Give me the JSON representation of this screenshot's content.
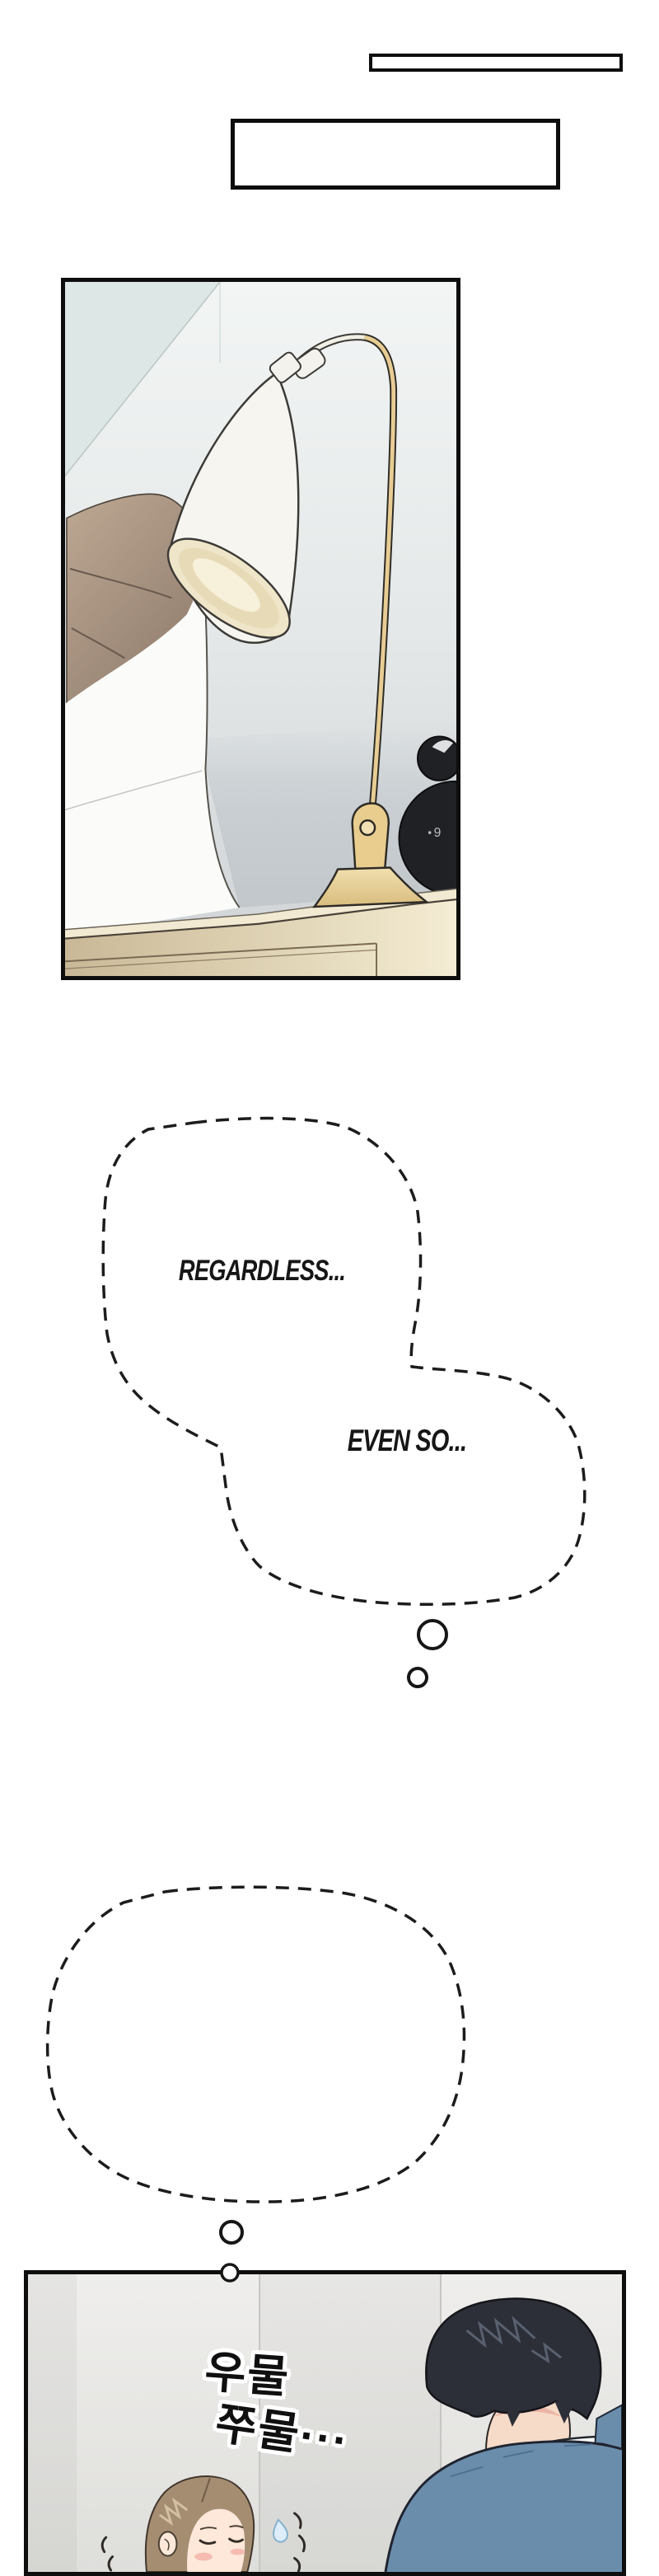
{
  "page": {
    "background": "#ffffff",
    "type": "webtoon-strip"
  },
  "caption_boxes": {
    "small": {
      "border_color": "#0d0d0d",
      "fill": "#ffffff",
      "text": ""
    },
    "large": {
      "border_color": "#0d0d0d",
      "fill": "#ffffff",
      "text": ""
    }
  },
  "thought_bubble_1": {
    "line1": "REGARDLESS...",
    "line2": "EVEN SO...",
    "style": "dashed-outline"
  },
  "thought_bubble_2": {
    "line1": "MUST I REALLY BE",
    "line2": "IN THIS POSITION?",
    "style": "dashed-outline"
  },
  "sfx": {
    "line1": "우물",
    "line2": "쭈물···",
    "meaning": "fidgeting-hesitating"
  },
  "lamp_panel": {
    "clock_digit": "9",
    "colors": {
      "wall_light": "#f2f5f4",
      "wall_gray": "#c9cdd1",
      "mirror_teal": "#dde7e5",
      "pillow": "#ab9683",
      "sheet": "#fbfbf9",
      "lamp_shade": "#f6f5f0",
      "lamp_rim": "#efe5c8",
      "lamp_gold": "#e7cd94",
      "headboard": "#e3d5b4",
      "clock_black": "#202125"
    }
  },
  "couple_panel": {
    "colors": {
      "wall": "#ebeae8",
      "man_hair": "#2c2f37",
      "man_sweater": "#6b8dac",
      "man_collar": "#fdfdfc",
      "skin": "#f6dbc9",
      "woman_hair": "#a58d72",
      "woman_face": "#fde8da",
      "blush": "#f5b4aa",
      "sweat_drop": "#ddeefa"
    }
  }
}
